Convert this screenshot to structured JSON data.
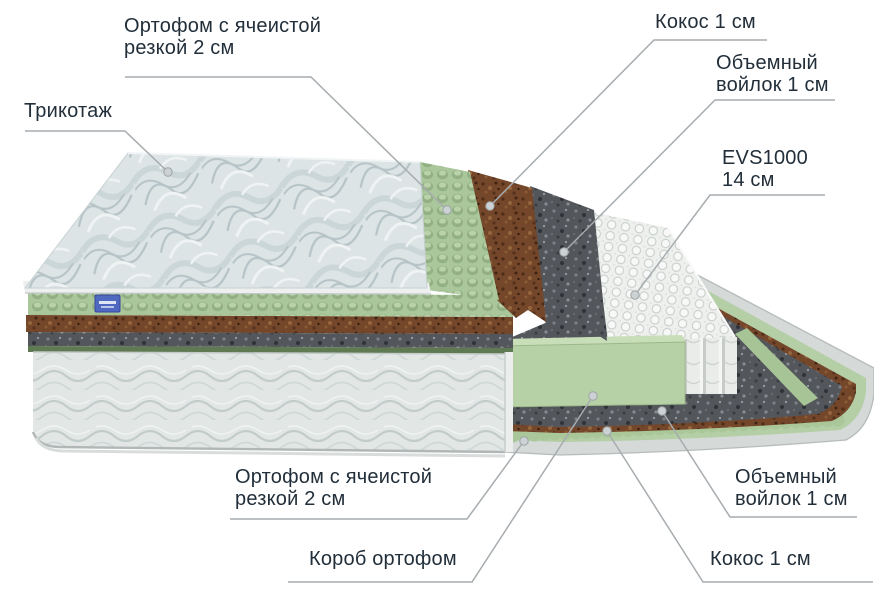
{
  "diagram": {
    "type": "mattress-layers-cutaway",
    "labels": {
      "ortofom_top": {
        "line1": "Ортофом с ячеистой",
        "line2": "резкой 2 см"
      },
      "trikotazh": {
        "line1": "Трикотаж"
      },
      "kokos_top": {
        "line1": "Кокос 1 см"
      },
      "voilok_top": {
        "line1": "Объемный",
        "line2": "войлок 1 см"
      },
      "evs": {
        "line1": "EVS1000",
        "line2": "14 см"
      },
      "ortofom_bottom": {
        "line1": "Ортофом с ячеистой",
        "line2": "резкой 2 см"
      },
      "korob": {
        "line1": "Короб ортофом"
      },
      "voilok_bottom": {
        "line1": "Объемный",
        "line2": "войлок 1 см"
      },
      "kokos_bottom": {
        "line1": "Кокос 1 см"
      }
    },
    "layers": [
      {
        "name": "Трикотаж"
      },
      {
        "name": "Ортофом с ячеистой резкой",
        "thickness": "2 см"
      },
      {
        "name": "Кокос",
        "thickness": "1 см"
      },
      {
        "name": "Объемный войлок",
        "thickness": "1 см"
      },
      {
        "name": "EVS1000",
        "thickness": "14 см"
      },
      {
        "name": "Объемный войлок",
        "thickness": "1 см"
      },
      {
        "name": "Кокос",
        "thickness": "1 см"
      },
      {
        "name": "Ортофом с ячеистой резкой",
        "thickness": "2 см"
      },
      {
        "name": "Короб ортофом"
      }
    ],
    "colors": {
      "text": "#222f3a",
      "leader_line": "#a7acaf",
      "foam_green": "#a9c79a",
      "coir_brown": "#774a2c",
      "felt_gray": "#54565b",
      "spring_white": "#eff1ef",
      "fabric_light": "#e2e7e6",
      "tag_blue": "#4f68c0"
    }
  }
}
